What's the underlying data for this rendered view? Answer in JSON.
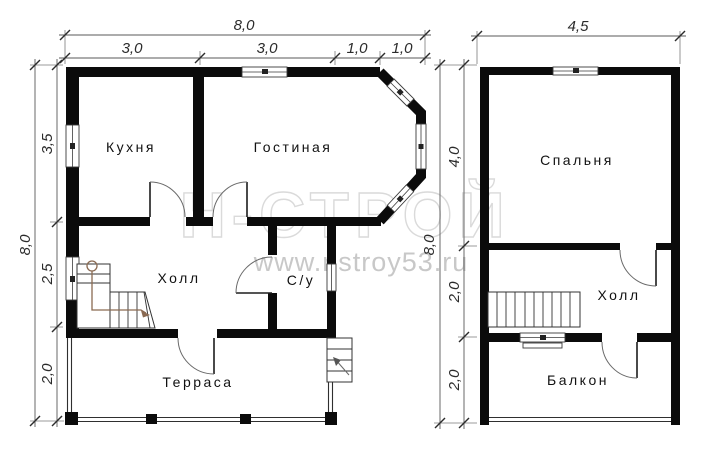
{
  "watermark": {
    "brand": "Н-СТРОЙ",
    "url": "www.nstroy53.ru"
  },
  "colors": {
    "wall": "#0b0b0b",
    "stair_path": "#8a6a52",
    "watermark": "#c8c8c8",
    "background": "#ffffff"
  },
  "floor1": {
    "dims_top": {
      "total": "8,0",
      "segments": [
        "3,0",
        "3,0",
        "1,0",
        "1,0"
      ]
    },
    "dims_left": {
      "total": "8,0",
      "segments": [
        "3,5",
        "2,5",
        "2,0"
      ]
    },
    "rooms": {
      "kitchen": "Кухня",
      "living": "Гостиная",
      "hall": "Холл",
      "wc": "С/у",
      "terrace": "Терраса"
    }
  },
  "floor2": {
    "dims_top": {
      "total": "4,5"
    },
    "dims_left": {
      "total": "8,0",
      "segments": [
        "4,0",
        "2,0",
        "2,0"
      ]
    },
    "rooms": {
      "bedroom": "Спальня",
      "hall": "Холл",
      "balcony": "Балкон"
    }
  }
}
